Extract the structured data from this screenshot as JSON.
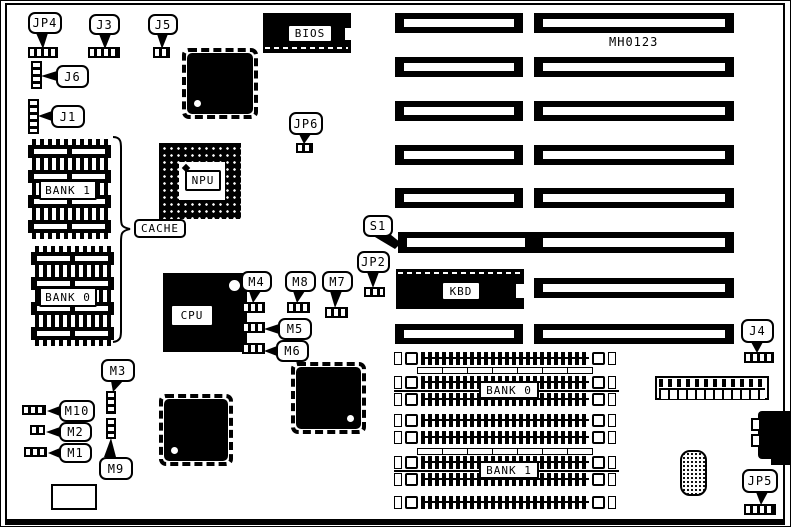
{
  "board": {
    "part_number": "MH0123",
    "colors": {
      "ink": "#000000",
      "paper": "#ffffff"
    }
  },
  "chips": {
    "bios": {
      "label": "BIOS"
    },
    "kbd": {
      "label": "KBD"
    },
    "npu": {
      "label": "NPU"
    },
    "cpu": {
      "label": "CPU"
    }
  },
  "cache": {
    "label": "CACHE",
    "bank1": "BANK 1",
    "bank0": "BANK 0"
  },
  "dram": {
    "bank0": "BANK 0",
    "bank1": "BANK 1"
  },
  "callouts": {
    "jp4": "JP4",
    "j3": "J3",
    "j5": "J5",
    "j6": "J6",
    "j1": "J1",
    "jp6": "JP6",
    "s1": "S1",
    "jp2": "JP2",
    "m4": "M4",
    "m8": "M8",
    "m7": "M7",
    "m5": "M5",
    "m6": "M6",
    "m3": "M3",
    "m10": "M10",
    "m2": "M2",
    "m1": "M1",
    "m9": "M9",
    "j4": "J4",
    "jp5": "JP5"
  }
}
